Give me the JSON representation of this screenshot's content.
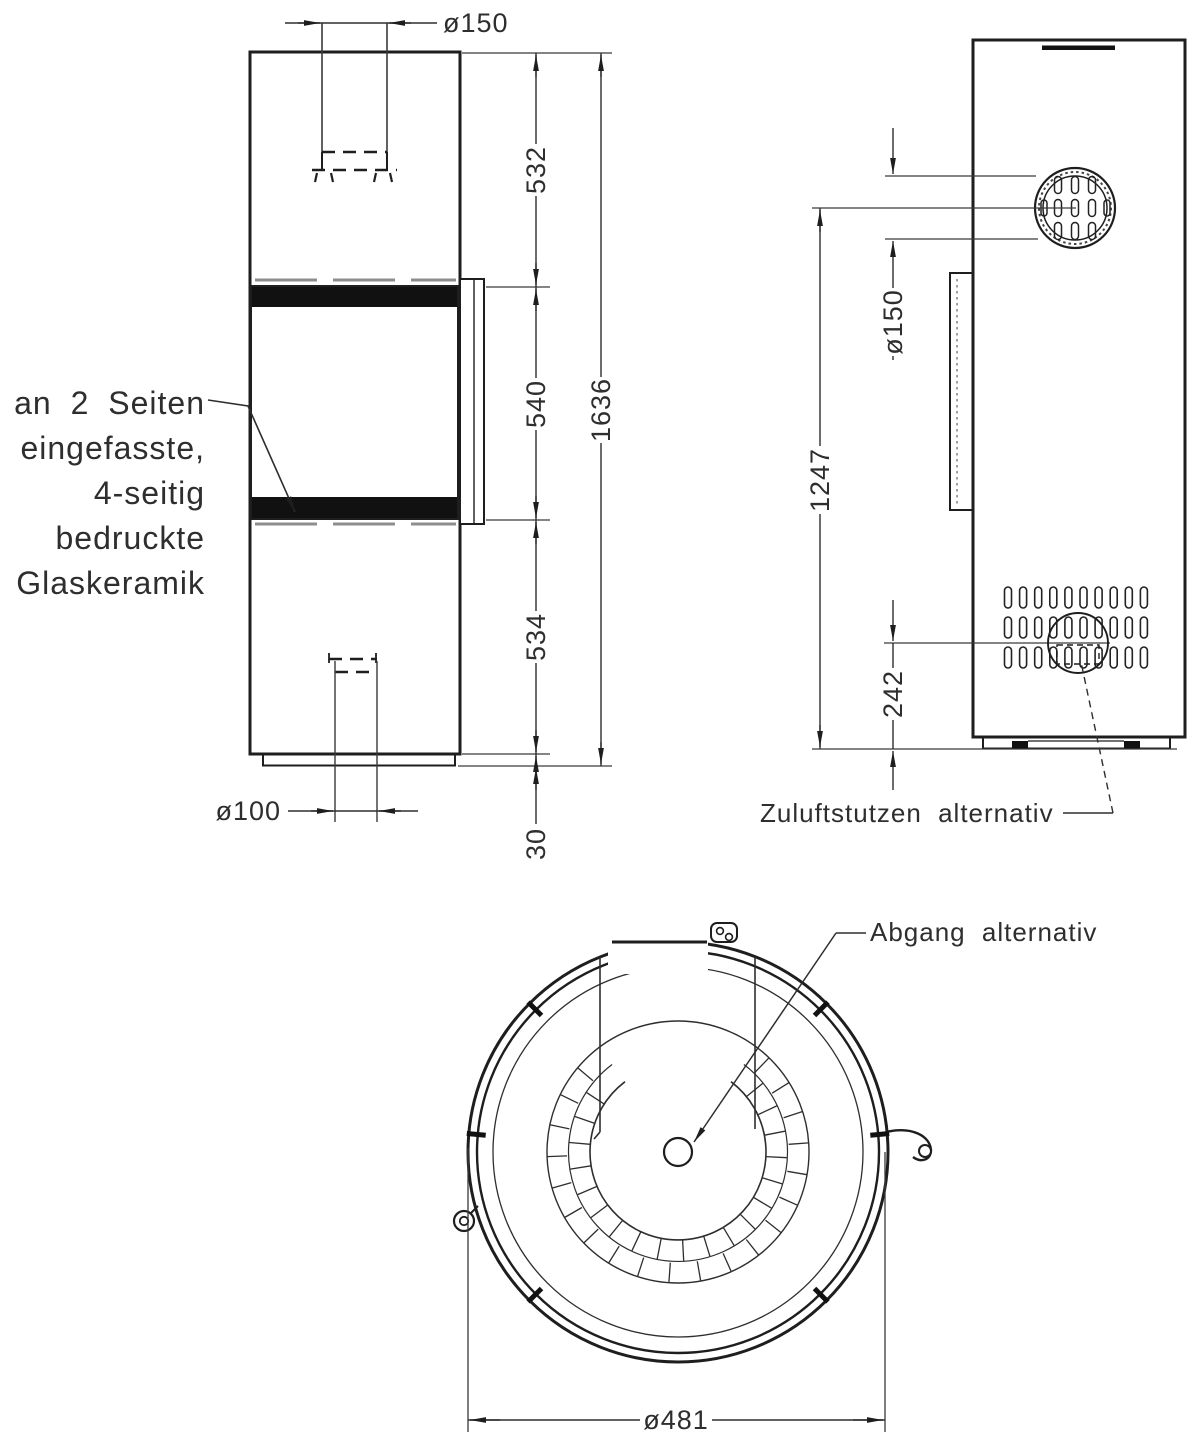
{
  "drawing": {
    "kind": "stove-technical-drawing",
    "front": {
      "dims": {
        "top_pipe_dia": "ø150",
        "upper_section": "532",
        "window_height": "540",
        "lower_section": "534",
        "plinth_height": "30",
        "total_height": "1636",
        "bottom_inlet_dia": "ø100"
      },
      "glass_note": [
        "an 2 Seiten",
        "eingefasste,",
        "4-seitig",
        "bedruckte",
        "Glaskeramik"
      ]
    },
    "side": {
      "dims": {
        "flue_dia": "ø150",
        "height_to_flue": "1247",
        "inlet_height": "242"
      },
      "labels": {
        "air_inlet": "Zuluftstutzen alternativ"
      }
    },
    "top": {
      "dims": {
        "body_dia": "ø481"
      },
      "labels": {
        "flue_outlet": "Abgang alternativ"
      }
    },
    "colors": {
      "line": "#1e1e1e",
      "text": "#2e2e2e",
      "band": "#111111"
    }
  }
}
